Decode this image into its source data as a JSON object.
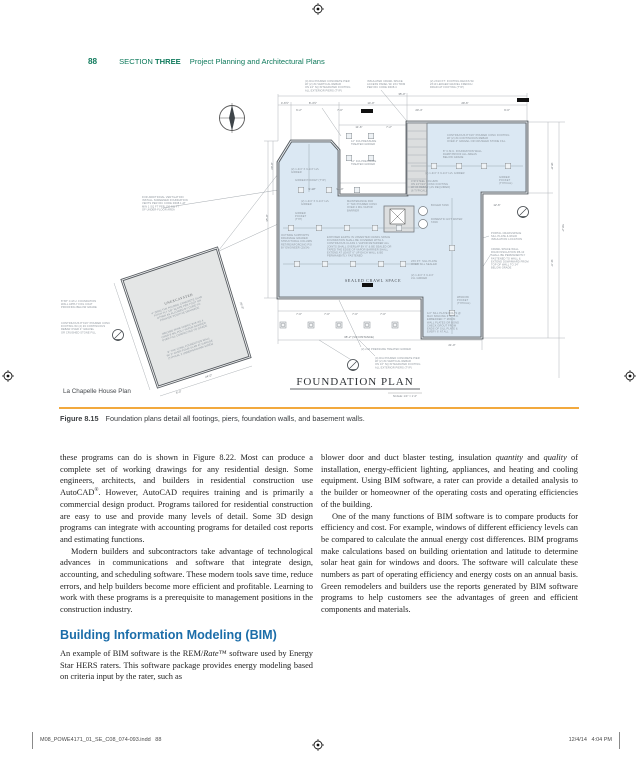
{
  "colors": {
    "header_green": "#0f7a5c",
    "heading_blue": "#1b6da9",
    "rule_orange": "#f2a93e",
    "plan_fill": "#dbe8f3",
    "garage_fill": "#e4e6e6",
    "wall": "#54595e",
    "annotation": "#8b939b",
    "dim_text": "#6e747a"
  },
  "header": {
    "page_number": "88",
    "section_word": "SECTION",
    "section_number": "THREE",
    "section_title": "Project Planning and Architectural Plans"
  },
  "figure": {
    "plan_caption": "La Chapelle House Plan",
    "label": "Figure 8.15",
    "caption": "Foundation plans detail all footings, piers, foundation walls, and basement walls.",
    "drawing": {
      "title": "FOUNDATION PLAN",
      "scale": "SCALE: 1/4\" = 1'-0\"",
      "sealed_label": "SEALED CRAWL SPACE",
      "unexcavated_label": "UNEXCAVATED",
      "annotations": [
        {
          "x": 246,
          "y": 4,
          "lines": [
            "(4) DIA POURED CONCRETE PIER",
            "W/ (2) #4 VERTICAL REBAR",
            "ON 24\" SQ INTEGRATED FOOTING",
            "ALL EXTERIOR PIERS (TYP)"
          ]
        },
        {
          "x": 308,
          "y": 4,
          "lines": [
            "INSULATED CRAWL SPACE",
            "ACCESS PANEL W/ 2X4 TRIM",
            "PER IRC CODE R408.4"
          ]
        },
        {
          "x": 371,
          "y": 4,
          "lines": [
            "(2) 2X10 P.T. FOOTING DECKS W/",
            "2X10 LEDGER GRAVEL FRENCH",
            "DRAIN AT FOOTING (TYP)"
          ]
        },
        {
          "x": 388,
          "y": 58,
          "lines": [
            "CONTINUOUS 8\"X16\" POURED CONC FOOTING",
            "W/ (2) #4 CONTINUOUS REBAR",
            "OVER 4\" GRAVEL OR CRUSHED STONE FILL"
          ]
        },
        {
          "x": 384,
          "y": 74,
          "lines": [
            "8\" C.M.U. FOUNDATION WALL",
            "DAMP PROOF ALL AREAS",
            "BELOW GRADE"
          ]
        },
        {
          "x": 366,
          "y": 96,
          "lines": [
            "(2) 1-3/4\" X 9-1/4\" LVL GIRDER"
          ]
        },
        {
          "x": 352,
          "y": 104,
          "lines": [
            "4\"Ø STEEL COLUMN",
            "ON 24\"X24\" CONC FOOTING",
            "W/ #4 REBAR (AS REQUIRED)",
            "(6 TYPICAL)"
          ]
        },
        {
          "x": 440,
          "y": 100,
          "lines": [
            "GIRDER",
            "POCKET",
            "(TYPICAL)"
          ]
        },
        {
          "x": 83,
          "y": 120,
          "lines": [
            "FOR ADDITIONAL VENTILATION",
            "INSTALL SCREENED FOUNDATION",
            "VENTS PER IRC CODE R408.1 AT",
            "MIN 1 SQ FT PER 150 SQ FT",
            "OF UNDER-FLOOR AREA"
          ]
        },
        {
          "x": 232,
          "y": 92,
          "lines": [
            "(2) 1-3/4\" X 9-1/4\" LVL",
            "GIRDER"
          ]
        },
        {
          "x": 236,
          "y": 103,
          "lines": [
            "GIRDER POCKET (TYP)"
          ]
        },
        {
          "x": 292,
          "y": 64,
          "lines": [
            "12\" DIA PRESSURE",
            "TREATED GIRDER"
          ]
        },
        {
          "x": 292,
          "y": 84,
          "lines": [
            "12\" DIA PRESSURE",
            "TREATED GIRDER"
          ]
        },
        {
          "x": 242,
          "y": 124,
          "lines": [
            "(2) 1-3/4\" X 9-1/4\" LVL",
            "GIRDER"
          ]
        },
        {
          "x": 236,
          "y": 136,
          "lines": [
            "GIRDER",
            "POCKET",
            "(TYP)"
          ]
        },
        {
          "x": 222,
          "y": 158,
          "lines": [
            "OUTSIDE SUPPORTS",
            "DRAINAGE GRADED",
            "STRUCTURAL COLUMN",
            "RET/REINFORCING PSI",
            "BY ENGINEER (20/24)"
          ]
        },
        {
          "x": 268,
          "y": 160,
          "lines": [
            "EXPOSED EARTH IN UNVENTED CRAWL SPACE",
            "FOUNDATION SHALL BE COVERED WITH A",
            "CONTINUOUS CLASS 1 VAPOR RETARDER ALL",
            "JOINTS SHALL OVERLAP BY 6\" & BE SEALED OR",
            "TAPED THE EDGE OF VAPOR BARRIER SHALL",
            "EXTEND AT LEAST 6\" UP EACH WALL & BE",
            "PERMANENTLY FASTENED"
          ]
        },
        {
          "x": 288,
          "y": 124,
          "lines": [
            "MAINTENANCE PAD",
            "4\" THK POURED CONC",
            "OVER 2 MIL VAPOR",
            "BARRIER"
          ]
        },
        {
          "x": 372,
          "y": 128,
          "lines": [
            "BOILER TANK"
          ]
        },
        {
          "x": 372,
          "y": 142,
          "lines": [
            "DOMESTIC HOT WATER",
            "TANK"
          ]
        },
        {
          "x": 432,
          "y": 156,
          "lines": [
            "PORTAL CRAWLSPACE",
            "SILL PLATE & RIGID",
            "INSULATION LOCATION"
          ]
        },
        {
          "x": 432,
          "y": 172,
          "lines": [
            "CRAWL SPACE WALL",
            "RIGID INSULATION R5-10",
            "SHALL BE PERMANENTLY",
            "FASTENED TO WALL &",
            "EXTEND DOWNWARD FROM",
            "TOP OF WALL TO 24\"",
            "BELOW GRADE"
          ]
        },
        {
          "x": 352,
          "y": 184,
          "lines": [
            "2X6 P.T. SILL PLATE",
            "OVER SILL SEALER"
          ]
        },
        {
          "x": 352,
          "y": 198,
          "lines": [
            "(2) 1-3/4\" X 9-1/4\"",
            "LVL GIRDER"
          ]
        },
        {
          "x": 398,
          "y": 220,
          "lines": [
            "WINDOW",
            "POCKET",
            "(TYPICAL)"
          ]
        },
        {
          "x": 368,
          "y": 236,
          "lines": [
            "1/2\" SILL PLATE BOLTS @",
            "MAX SPACING 6'-0\" O.C.",
            "EMBEDDED 7\" MIN IN",
            "WALL PLATES OR BOND",
            "CHECK GROUT FROM",
            "ENDS OF SILL PLATE &",
            "EVERY 6' AT ALL"
          ]
        },
        {
          "x": 302,
          "y": 272,
          "lines": [
            "(2) 2X6 PRESSURE TREATED GIRDER"
          ]
        },
        {
          "x": 316,
          "y": 281,
          "lines": [
            "(4) DIA POURED CONCRETE PIER",
            "W/ (2) #4 VERTICAL REBAR",
            "ON 16\" SQ INTEGRATED FOOTING",
            "ALL EXTERIOR PIERS (TYP)"
          ]
        },
        {
          "x": 2,
          "y": 224,
          "lines": [
            "8\"X8\" C.M.U. FOUNDATION",
            "WALL APPLY FOG COAT",
            "PROOFING BELOW GRADE"
          ]
        },
        {
          "x": 2,
          "y": 246,
          "lines": [
            "CONTINUOUS 8\"X16\" POURED CONC",
            "FOOTING W/ (2) #4 CONTINUOUS",
            "REBAR OVER 4\" GRAVEL",
            "OR CRUSHED STONE FILL"
          ]
        },
        {
          "x": 118,
          "y": 228,
          "r": -18.5,
          "a": "m",
          "lines": [
            "4\" (MIN) THK POURED CONCRETE SLAB",
            "PITCH FLY 1/8\" SLOPE PER FOOT OR",
            "OTHER AS ALLOWED BY CODE TO",
            "PROVIDE POSITIVE DRAINAGE"
          ]
        },
        {
          "x": 124,
          "y": 250,
          "r": -18.5,
          "a": "m",
          "lines": [
            "WELDED WIRE FABRIC 6X6 W1.4",
            "OVER 6 MIL POLY VAPOR BARRIER",
            "OVER FILL COMPACTED TO GRADE"
          ]
        },
        {
          "x": 130,
          "y": 268,
          "r": -18.5,
          "a": "m",
          "lines": [
            "8\" THK CONC FOUNDATION WALL",
            "W/ 2\" OVER-POUR SLAB AT GARAGE",
            "(TYPICAL 3 UNDERGROUND SIDES)"
          ]
        }
      ],
      "dims": [
        {
          "x": 226,
          "y": 26,
          "t": "4'-6½\""
        },
        {
          "x": 254,
          "y": 26,
          "t": "8'-4½\""
        },
        {
          "x": 312,
          "y": 26,
          "t": "14'-0\""
        },
        {
          "x": 406,
          "y": 26,
          "t": "29'-6\""
        },
        {
          "x": 240,
          "y": 33,
          "t": "6'-2\""
        },
        {
          "x": 281,
          "y": 33,
          "t": "7'-0\""
        },
        {
          "x": 360,
          "y": 33,
          "t": "20'-4\""
        },
        {
          "x": 448,
          "y": 33,
          "t": "9'-0\""
        },
        {
          "x": 343,
          "y": 17,
          "t": "35'-0\""
        },
        {
          "x": 300,
          "y": 50,
          "t": "11'-6\""
        },
        {
          "x": 330,
          "y": 50,
          "t": "7'-2\""
        },
        {
          "x": 253,
          "y": 112,
          "t": "9'-10\""
        },
        {
          "x": 281,
          "y": 112,
          "t": "9'-10\""
        },
        {
          "x": 492,
          "y": 88,
          "r": 90,
          "t": "18'-8\""
        },
        {
          "x": 492,
          "y": 185,
          "r": 90,
          "t": "31'-6\""
        },
        {
          "x": 503,
          "y": 150,
          "r": 90,
          "t": "50'-2\""
        },
        {
          "x": 209,
          "y": 140,
          "r": -90,
          "t": "35'-0\""
        },
        {
          "x": 214,
          "y": 88,
          "r": -90,
          "t": "20'-0\""
        },
        {
          "x": 240,
          "y": 237,
          "t": "7'-0\""
        },
        {
          "x": 268,
          "y": 237,
          "t": "7'-0\""
        },
        {
          "x": 296,
          "y": 237,
          "t": "7'-0\""
        },
        {
          "x": 324,
          "y": 237,
          "t": "7'-0\""
        },
        {
          "x": 300,
          "y": 260,
          "t": "38'-2\" (VIF DISTANCE)"
        },
        {
          "x": 393,
          "y": 268,
          "t": "21'-0\""
        },
        {
          "x": 438,
          "y": 128,
          "t": "12'-6\""
        },
        {
          "x": 150,
          "y": 299,
          "r": -18.5,
          "t": "24'-0\""
        },
        {
          "x": 182,
          "y": 228,
          "r": 71,
          "t": "26'-8\""
        },
        {
          "x": 120,
          "y": 315,
          "r": -18.5,
          "t": "8'-0\""
        }
      ],
      "piers": {
        "interior": [
          [
            242,
            112
          ],
          [
            270,
            112
          ],
          [
            298,
            112
          ],
          [
            232,
            150
          ],
          [
            260,
            150
          ],
          [
            288,
            150
          ],
          [
            316,
            150
          ],
          [
            340,
            150
          ],
          [
            238,
            186
          ],
          [
            266,
            186
          ],
          [
            294,
            186
          ],
          [
            322,
            186
          ],
          [
            344,
            186
          ],
          [
            375,
            88
          ],
          [
            400,
            88
          ],
          [
            425,
            88
          ],
          [
            449,
            88
          ],
          [
            393,
            170
          ],
          [
            393,
            235
          ]
        ],
        "notch": [
          [
            290,
            58
          ],
          [
            312,
            58
          ],
          [
            290,
            80
          ],
          [
            312,
            80
          ]
        ],
        "bottom": [
          [
            224,
            247
          ],
          [
            252,
            247
          ],
          [
            280,
            247
          ],
          [
            308,
            247
          ],
          [
            336,
            247
          ]
        ]
      }
    }
  },
  "body": {
    "left": {
      "p1": [
        {
          "t": "these programs can do is shown in Figure 8.22. Most can produce a complete set of working drawings for any residential design. Some engineers, architects, and builders in residential construction use AutoCAD"
        },
        {
          "t": "®",
          "s": true
        },
        {
          "t": ". However, AutoCAD requires training and is primarily a commercial design product. Programs tailored for residential construction are easy to use and provide many levels of detail. Some 3D design programs can integrate with accounting programs for detailed cost reports and estimating functions."
        }
      ],
      "p2": [
        {
          "t": "Modern builders and subcontractors take advantage of technological advances in communications and software that integrate design, accounting, and scheduling software. These modern tools save time, reduce errors, and help builders become more efficient and profitable. Learning to work with these programs is a prerequisite to management positions in the construction industry."
        }
      ],
      "heading": "Building Information Modeling (BIM)",
      "p3": [
        {
          "t": "An example of BIM software is the REM/"
        },
        {
          "t": "Rate",
          "i": true
        },
        {
          "t": "™ software used by Energy Star HERS raters. This software package provides energy modeling based on criteria input by the rater, such as"
        }
      ]
    },
    "right": {
      "p1": [
        {
          "t": "blower door and duct blaster testing, insulation "
        },
        {
          "t": "quantity",
          "i": true
        },
        {
          "t": " and "
        },
        {
          "t": "quality",
          "i": true
        },
        {
          "t": " of installation, energy-efficient lighting, appliances, and heating and cooling equipment. Using BIM software, a rater can provide a detailed analysis to the builder or homeowner of the operating costs and operating efficiencies of the building."
        }
      ],
      "p2": [
        {
          "t": "One of the many functions of BIM software is to compare products for efficiency and cost. For example, windows of different efficiency levels can be compared to calculate the annual energy cost differences. BIM programs make calculations based on building orientation and latitude to determine solar heat gain for windows and doors. The software will calculate these numbers as part of operating efficiency and energy costs on an annual basis. Green remodelers and builders use the reports generated by BIM software programs to help customers see the advantages of green and efficient components and materials."
        }
      ]
    }
  },
  "footer": {
    "left": "M08_POWE4171_01_SE_C08_074-093.indd   88",
    "right": "12/4/14   4:04 PM"
  }
}
